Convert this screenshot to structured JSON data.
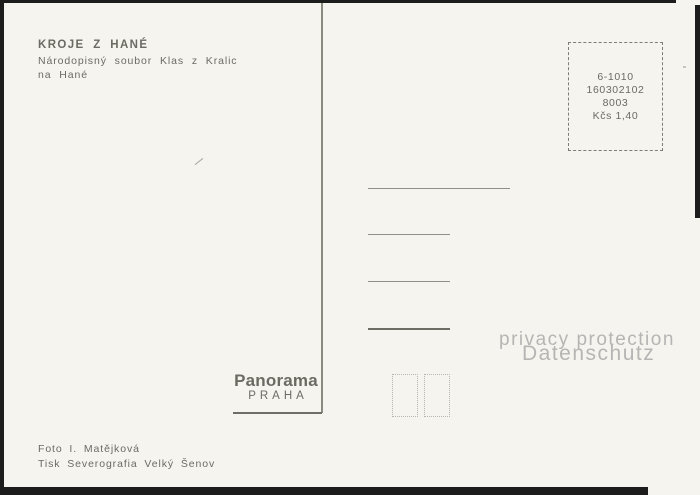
{
  "postcard": {
    "title": "KROJE Z HANÉ",
    "subtitle_line1": "Národopisný soubor Klas z Kralic",
    "subtitle_line2": "na Hané",
    "stamp_box": {
      "lines": [
        "6-1010",
        "160302102",
        "8003",
        "Kčs 1,40"
      ]
    },
    "publisher": {
      "name": "Panorama",
      "city": "PRAHA"
    },
    "footer_line1": "Foto I. Matějková",
    "footer_line2": "Tisk Severografia Velký Šenov",
    "watermark": {
      "line1": "privacy protection",
      "line2": "Datenschutz"
    },
    "address_lines_count": 4
  },
  "colors": {
    "card_background": "#f5f4ef",
    "ink_text": "#6b6b63",
    "scan_edge": "#1c1c1c",
    "divider_line": "#8a8a80",
    "watermark_text": "#b5b5b3",
    "dotted_box_border": "#b6b6ad"
  }
}
